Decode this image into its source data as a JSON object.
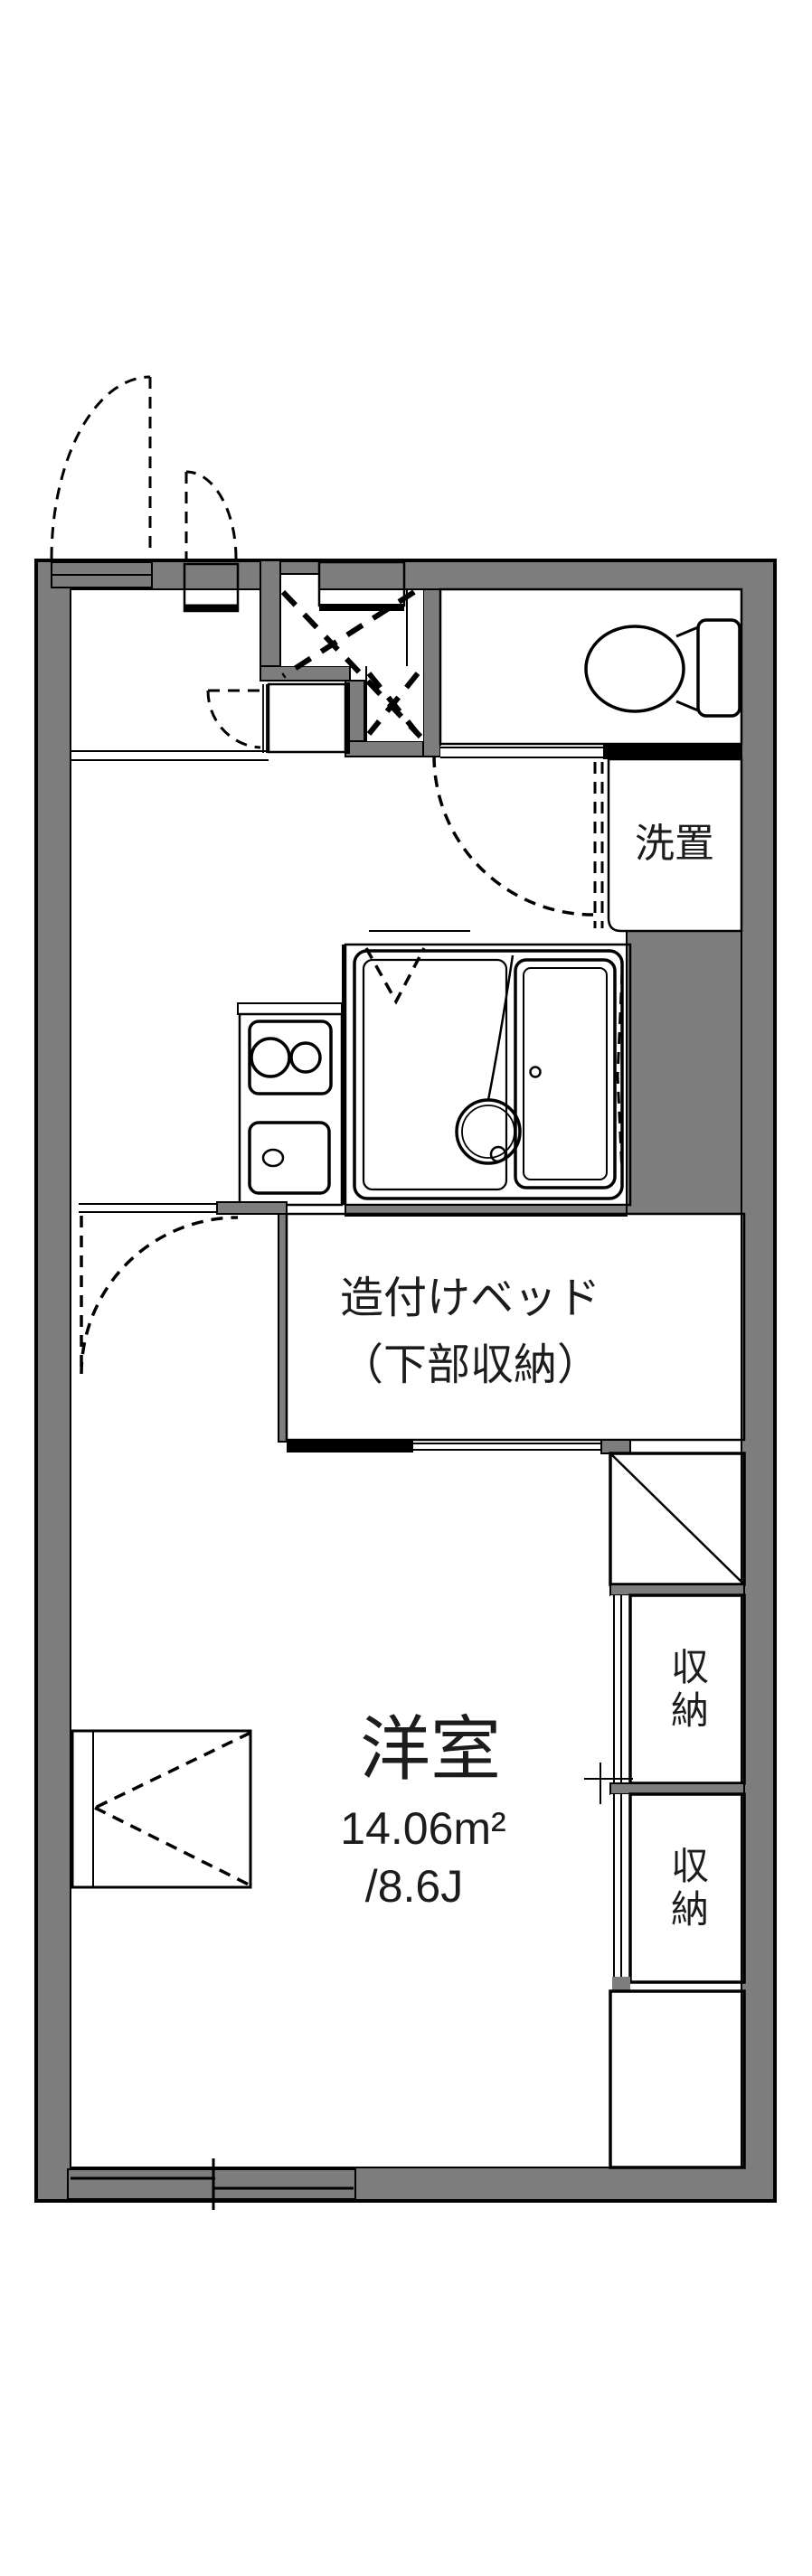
{
  "colors": {
    "wall_gray": "#7d7d7d",
    "water_room_blue": "#dce9f8",
    "storage_cream": "#faf0da",
    "line_black": "#000000",
    "background_white": "#ffffff"
  },
  "rooms": {
    "laundry": {
      "label": "洗置"
    },
    "built_in_bed": {
      "label_line1": "造付けベッド",
      "label_line2": "（下部収納）"
    },
    "western_room": {
      "name": "洋室",
      "area_sqm": "14.06m²",
      "area_tatami": "/8.6J"
    },
    "storage_top": {
      "label": "収納"
    },
    "storage_bottom": {
      "label": "収納"
    }
  }
}
